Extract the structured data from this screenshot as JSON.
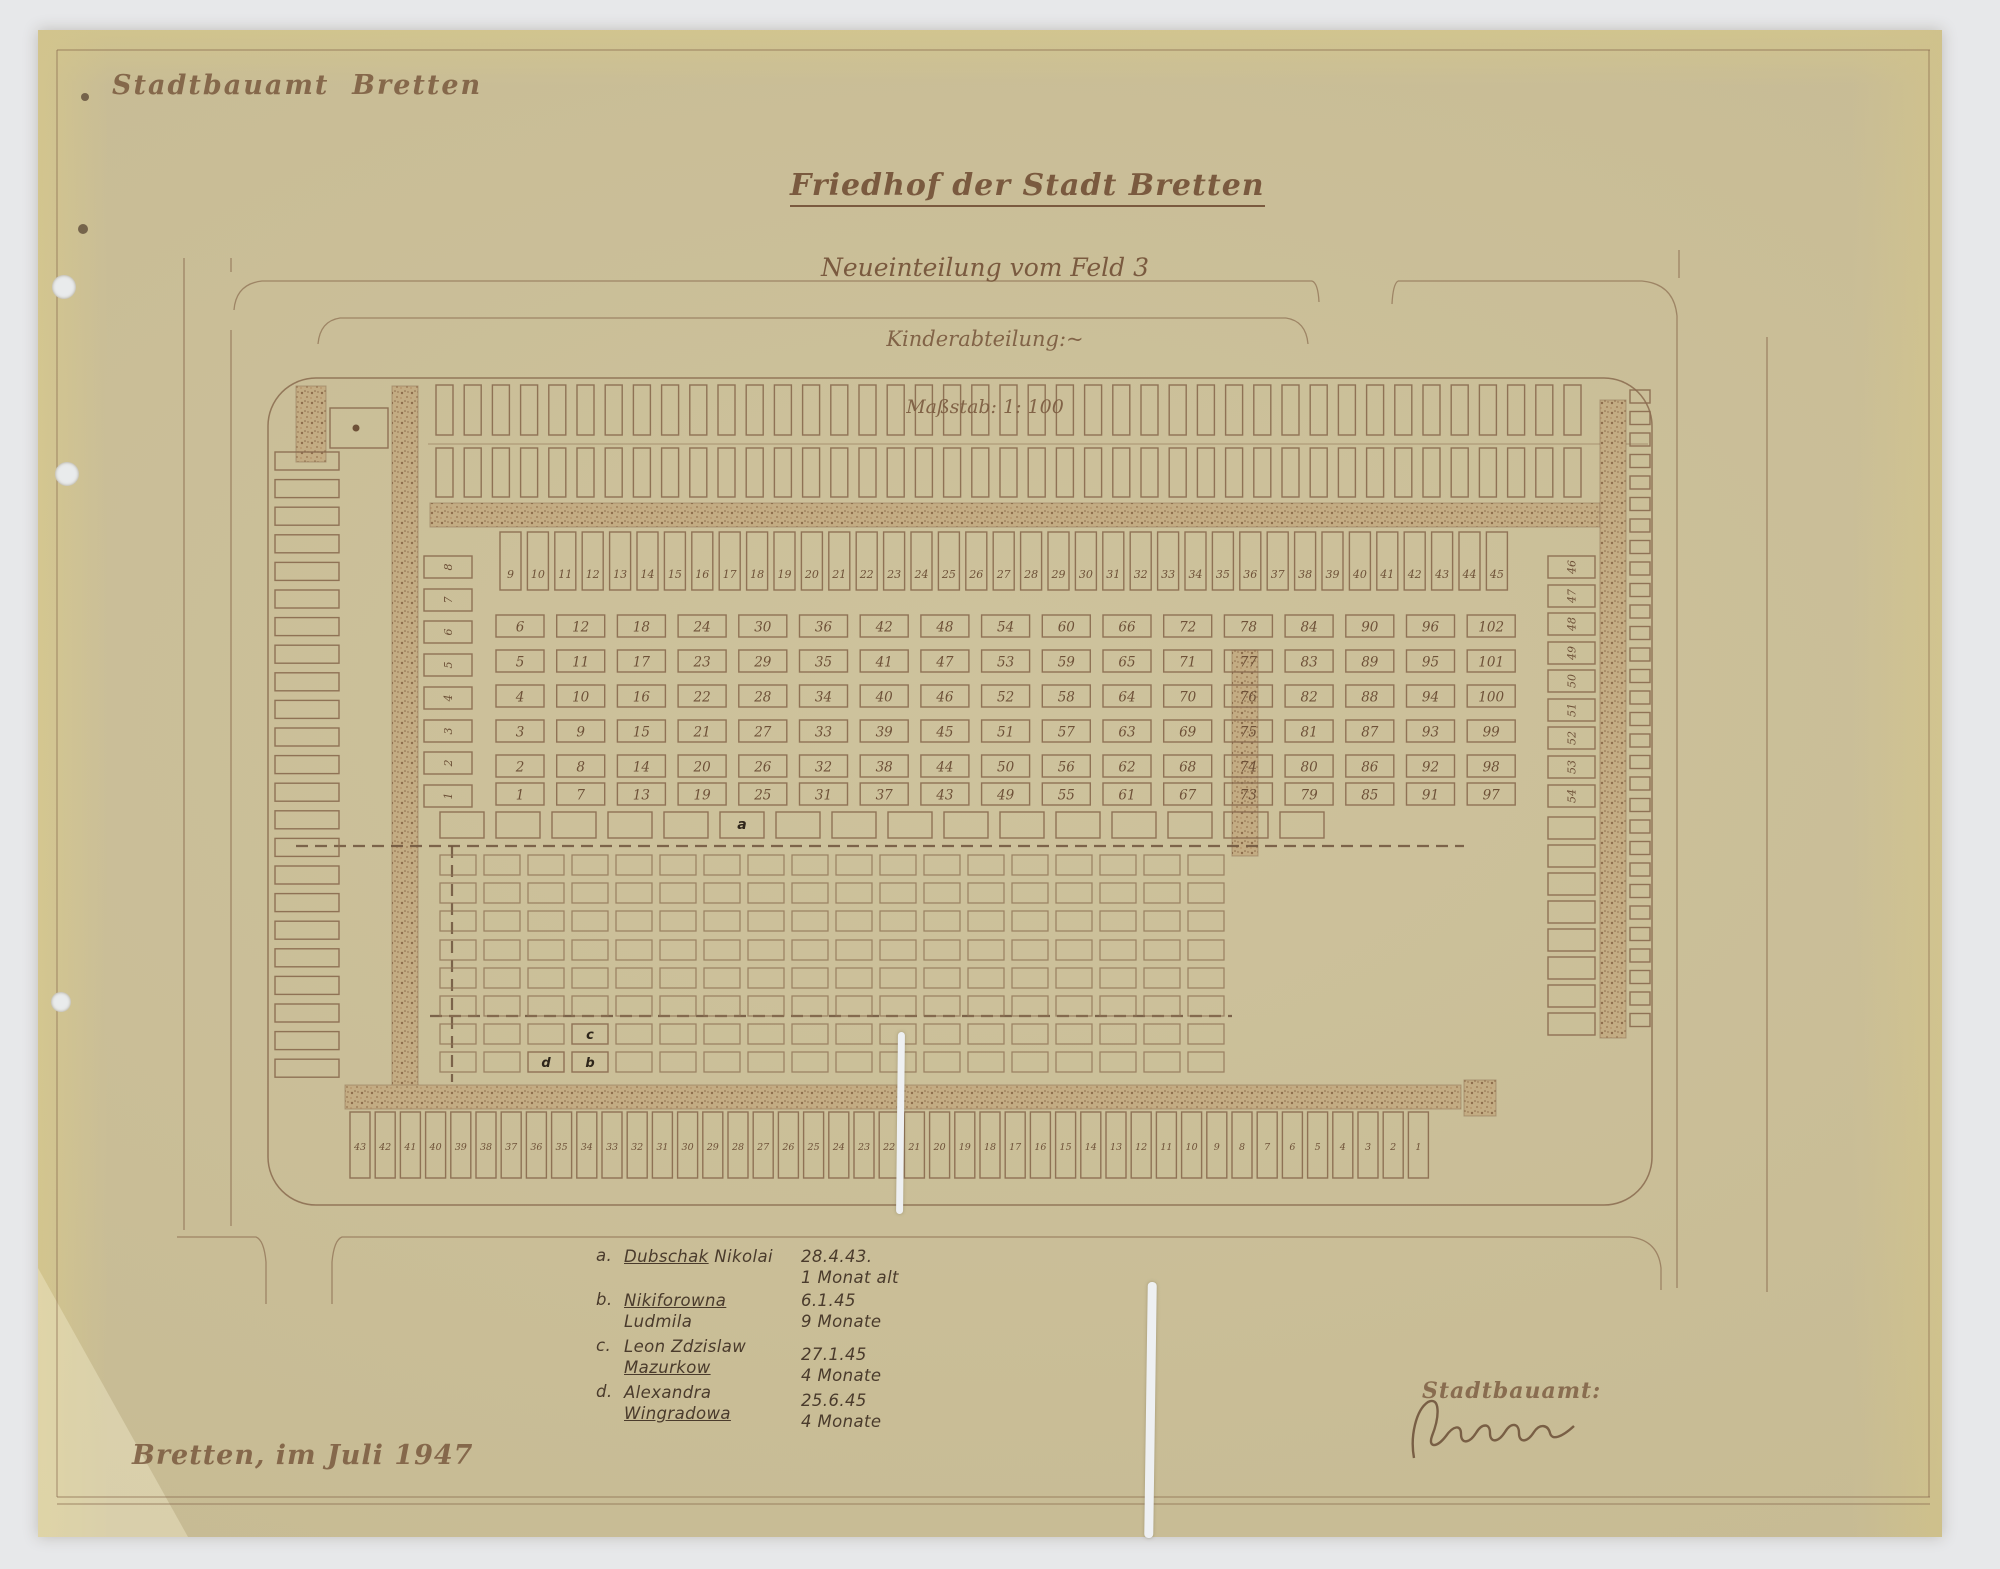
{
  "header": {
    "office": "Stadtbauamt  Bretten"
  },
  "title": {
    "line1": "Friedhof der Stadt Bretten",
    "line2": "Neueinteilung vom Feld 3",
    "line3": "Kinderabteilung:~",
    "line4": "Maßstab: 1: 100"
  },
  "plan": {
    "left_column_numbers": [
      8,
      7,
      6,
      5,
      4,
      3,
      2,
      1
    ],
    "top_row_numbers": [
      9,
      10,
      11,
      12,
      13,
      14,
      15,
      16,
      17,
      18,
      19,
      20,
      21,
      22,
      23,
      24,
      25,
      26,
      27,
      28,
      29,
      30,
      31,
      32,
      33,
      34,
      35,
      36,
      37,
      38,
      39,
      40,
      41,
      42,
      43,
      44,
      45
    ],
    "right_column_numbers": [
      46,
      47,
      48,
      49,
      50,
      51,
      52,
      53,
      54
    ],
    "grid_numbers_by_row": [
      [
        6,
        12,
        18,
        24,
        30,
        36,
        42,
        48,
        54,
        60,
        66,
        72,
        78,
        84,
        90,
        96,
        102
      ],
      [
        5,
        11,
        17,
        23,
        29,
        35,
        41,
        47,
        53,
        59,
        65,
        71,
        77,
        83,
        89,
        95,
        101
      ],
      [
        4,
        10,
        16,
        22,
        28,
        34,
        40,
        46,
        52,
        58,
        64,
        70,
        76,
        82,
        88,
        94,
        100
      ],
      [
        3,
        9,
        15,
        21,
        27,
        33,
        39,
        45,
        51,
        57,
        63,
        69,
        75,
        81,
        87,
        93,
        99
      ],
      [
        2,
        8,
        14,
        20,
        26,
        32,
        38,
        44,
        50,
        56,
        62,
        68,
        74,
        80,
        86,
        92,
        98
      ],
      [
        1,
        7,
        13,
        19,
        25,
        31,
        37,
        43,
        49,
        55,
        61,
        67,
        73,
        79,
        85,
        91,
        97
      ]
    ],
    "bottom_row_numbers": [
      43,
      42,
      41,
      40,
      39,
      38,
      37,
      36,
      35,
      34,
      33,
      32,
      31,
      30,
      29,
      28,
      27,
      26,
      25,
      24,
      23,
      22,
      21,
      20,
      19,
      18,
      17,
      16,
      15,
      14,
      13,
      12,
      11,
      10,
      9,
      8,
      7,
      6,
      5,
      4,
      3,
      2,
      1
    ],
    "unnumbered": {
      "top_outer_row": 41,
      "top_inner_row": 41,
      "left_outer_column": 23,
      "right_column_extra": 8,
      "far_right_column": 30,
      "single_row": 16,
      "lower_grid_rows": 8,
      "lower_grid_cols": 18
    },
    "markers": {
      "a": {
        "letter": "a",
        "index": 5
      },
      "cells": [
        {
          "letter": "c",
          "row": 6,
          "col": 3
        },
        {
          "letter": "b",
          "row": 7,
          "col": 3
        },
        {
          "letter": "d",
          "row": 7,
          "col": 2
        }
      ]
    },
    "colors": {
      "ink": "#8a6b4f",
      "number_ink": "#6e5138",
      "highlight_stripe": "#bf5f3a",
      "highlight_fill": "#dca57d",
      "paper": "#cbbf97"
    }
  },
  "legend": {
    "entries": [
      {
        "key": "a.",
        "name_u": "Dubschak",
        "name_rest": " Nikolai",
        "name2_u": "",
        "date": "28.4.43.",
        "age": "1 Monat alt"
      },
      {
        "key": "b.",
        "name_u": "Nikiforowna",
        "name_rest": " Ludmila",
        "name2_u": "",
        "date": "6.1.45",
        "age": "9 Monate"
      },
      {
        "key": "c.",
        "name_u": "",
        "name_rest": "Leon Zdzislaw",
        "name2_u": "Mazurkow",
        "date": "27.1.45",
        "age": "4 Monate"
      },
      {
        "key": "d.",
        "name_u": "",
        "name_rest": "Alexandra",
        "name2_u": "Wingradowa",
        "date": "25.6.45",
        "age": "4 Monate"
      }
    ]
  },
  "footer": {
    "place_date": "Bretten, im Juli 1947"
  },
  "signature": {
    "label": "Stadtbauamt:"
  }
}
